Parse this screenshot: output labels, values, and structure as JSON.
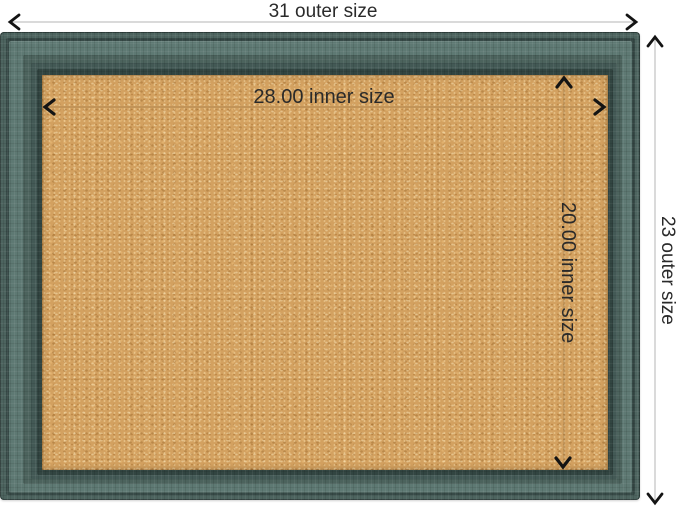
{
  "labels": {
    "outer_width": "31 outer size",
    "outer_height": "23 outer size",
    "inner_width": "28.00 inner size",
    "inner_height": "20.00 inner size"
  },
  "colors": {
    "background": "#ffffff",
    "frame_base": "#4d645f",
    "frame_groove": "#374a47",
    "frame_light": "#5e7973",
    "frame_mid": "#4c635d",
    "frame_dark2": "#435955",
    "frame_lip": "#324541",
    "cork_base": "#d3a160",
    "outer_line": "#b5b5b5",
    "inner_line": "rgba(122,94,58,0.38)",
    "arrow": "#141414",
    "label_text": "#2a2a2a"
  }
}
